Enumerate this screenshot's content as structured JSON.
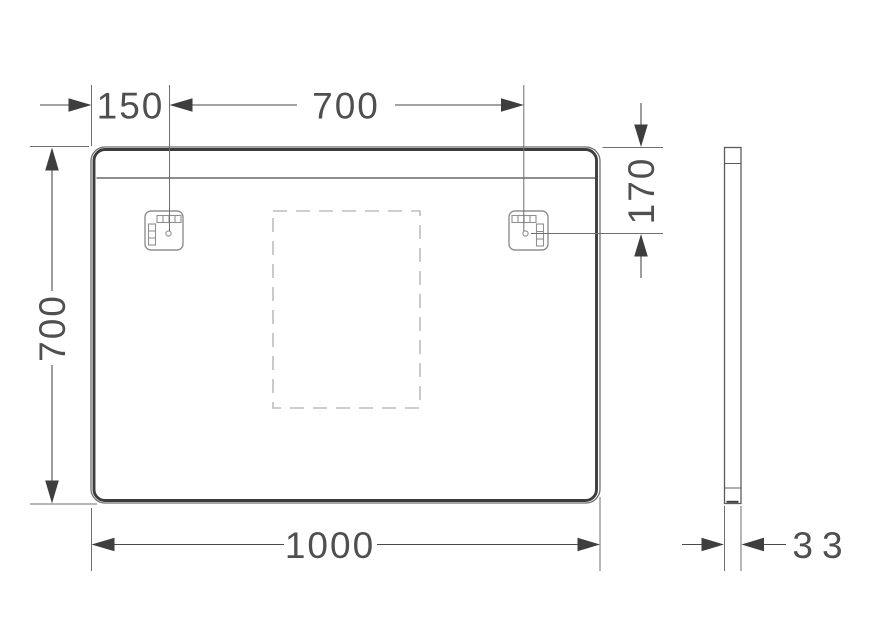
{
  "drawing": {
    "background": "#ffffff",
    "colors": {
      "outline": "#3c3c3c",
      "outline_light": "#6e6e6e",
      "dimension_lines": "#4a4a4a",
      "dimension_text": "#4f4f4f",
      "bracket": "#909090",
      "dashed_area": "#bdbdbd"
    },
    "front_view": {
      "bracket_offset_label": "150",
      "bracket_span_label": "700",
      "height_label": "700",
      "width_label": "1000",
      "bracket_drop_label": "170"
    },
    "side_view": {
      "depth_label": "33"
    }
  }
}
